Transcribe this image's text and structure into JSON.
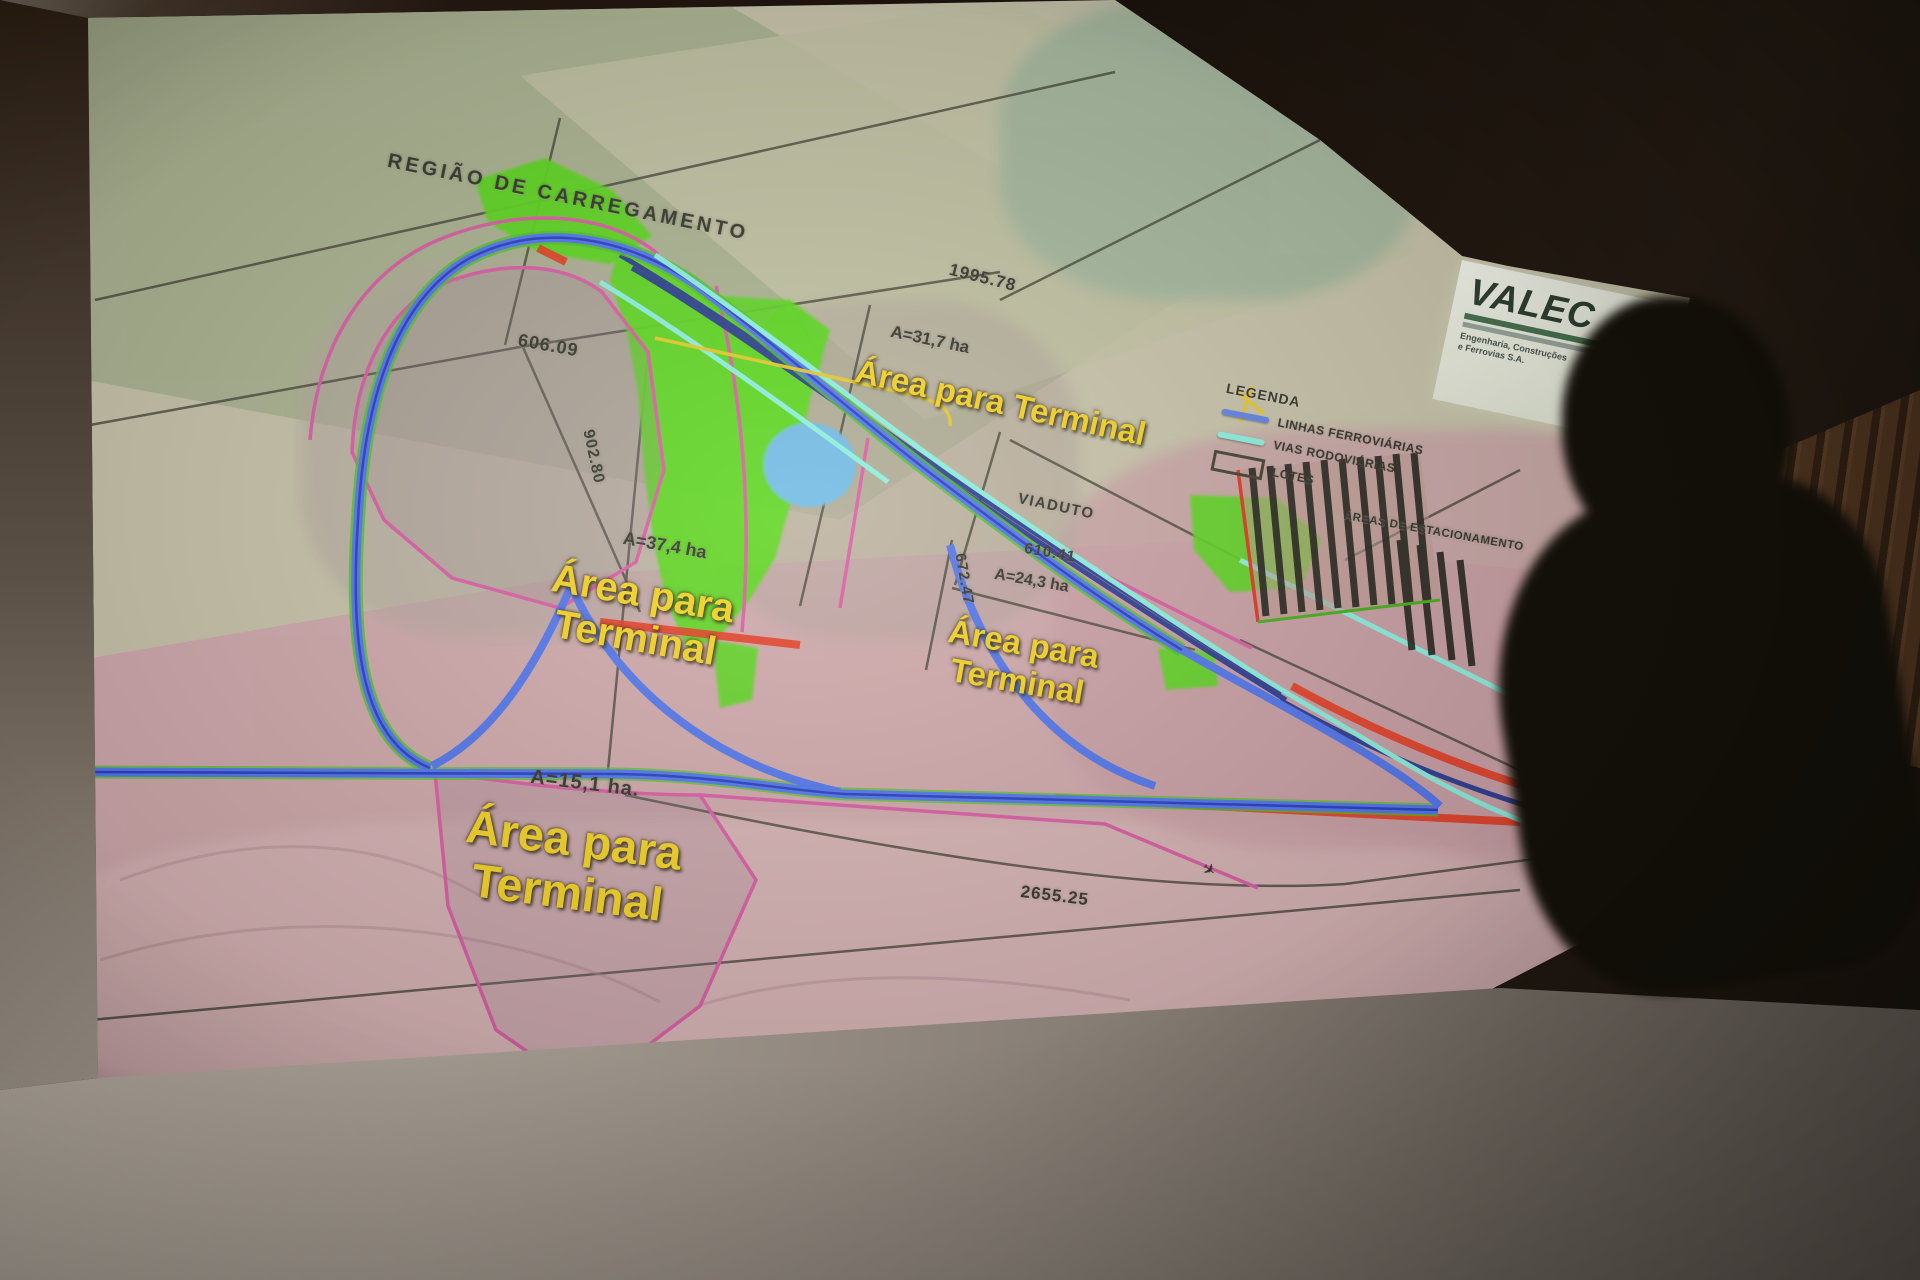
{
  "map": {
    "region_label": "REGIÃO DE CARREGAMENTO",
    "parking_label": "ÁREAS DE ESTACIONAMENTO",
    "viaduct_center": "VIADUTO",
    "viaduct_right": "VIADUTO",
    "terminal": {
      "top": {
        "text": "Área para Terminal",
        "area": "A=31,7 ha"
      },
      "left": {
        "line1": "Área para",
        "line2": "Terminal",
        "area": "A=37,4 ha"
      },
      "center": {
        "line1": "Área para",
        "line2": "Terminal",
        "area": "A=24,3 ha"
      },
      "bottom": {
        "line1": "Área para",
        "line2": "Terminal",
        "area": "A=15,1 ha."
      }
    },
    "measurements": [
      "1995.78",
      "606.09",
      "902.80",
      "610.41",
      "672.47",
      "2655.25"
    ],
    "legend": {
      "title": "LEGENDA",
      "items": [
        {
          "label": "LINHAS FERROVIÁRIAS",
          "swatch": "blue-line",
          "color": "#5b7fe8"
        },
        {
          "label": "VIAS RODOVIÁRIAS",
          "swatch": "cyan-line",
          "color": "#8af0df"
        },
        {
          "label": "LOTES",
          "swatch": "rect-outline",
          "color": "#3a3a2e"
        }
      ]
    },
    "logo": {
      "name": "VALEC",
      "tagline_line1": "Engenharia, Construções",
      "tagline_line2": "e Ferrovias S.A."
    },
    "symbols": {
      "plane": "✈"
    },
    "colors": {
      "road_blue": "#4d72ee",
      "road_green_edge": "#46c31e",
      "road_cyan": "#8af0df",
      "rail_navy": "#20328f",
      "lot_magenta": "#d957a2",
      "highlight_red": "#e63318",
      "vegetation_green": "#55d615",
      "water_blue": "#6cb8e6",
      "label_yellow": "#f4d21c"
    }
  }
}
